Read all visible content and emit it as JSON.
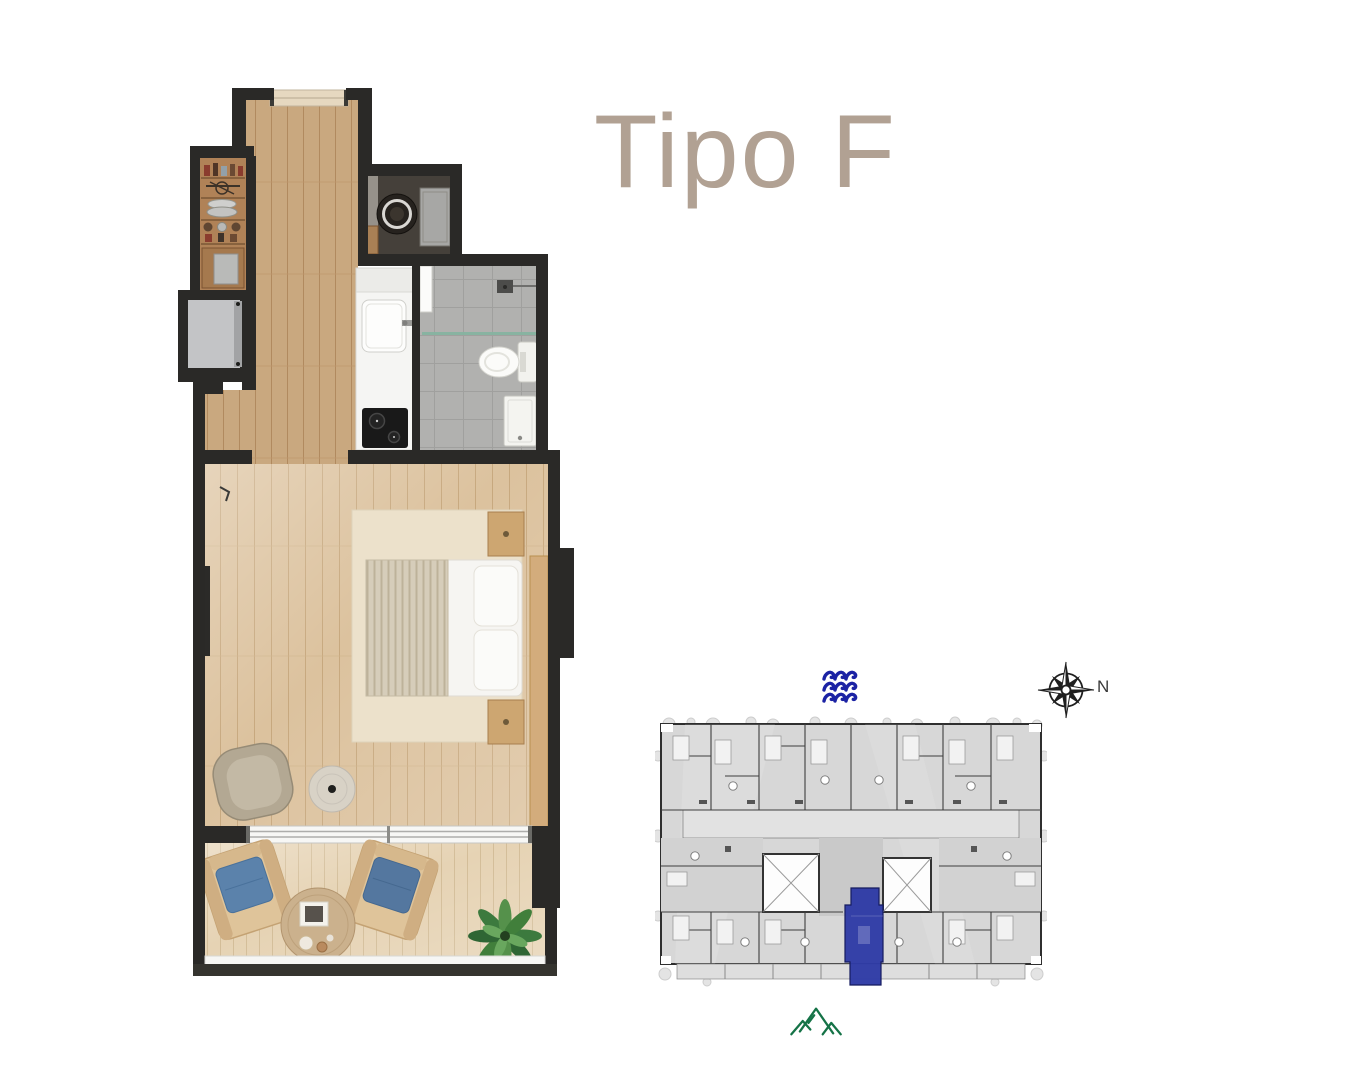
{
  "page": {
    "background_color": "#ffffff"
  },
  "title": {
    "text": "Tipo F",
    "color": "#b1a193"
  },
  "compass": {
    "north_label": "N"
  },
  "icons": {
    "waves": {
      "name": "sea-waves-icon",
      "color": "#1b22a4"
    },
    "compass_rose": {
      "name": "compass-rose-icon",
      "color": "#1f1f1f"
    },
    "mountains": {
      "name": "mountains-icon",
      "color": "#157347"
    }
  },
  "unit_plan": {
    "wall_color": "#2a2927",
    "corridor_wood_color": "#c9a87f",
    "living_wood_color": "#dcc29e",
    "balcony_wood_color": "#e6d3b4",
    "bathroom_tile_color": "#b1b1af",
    "cushion_blue_color": "#5b82ab",
    "plant_green_color": "#3c7a3e"
  },
  "key_plan": {
    "base_color": "#d7d7d7",
    "wall_line_color": "#3e3e3e",
    "highlight_color": "#2e3aa6"
  }
}
